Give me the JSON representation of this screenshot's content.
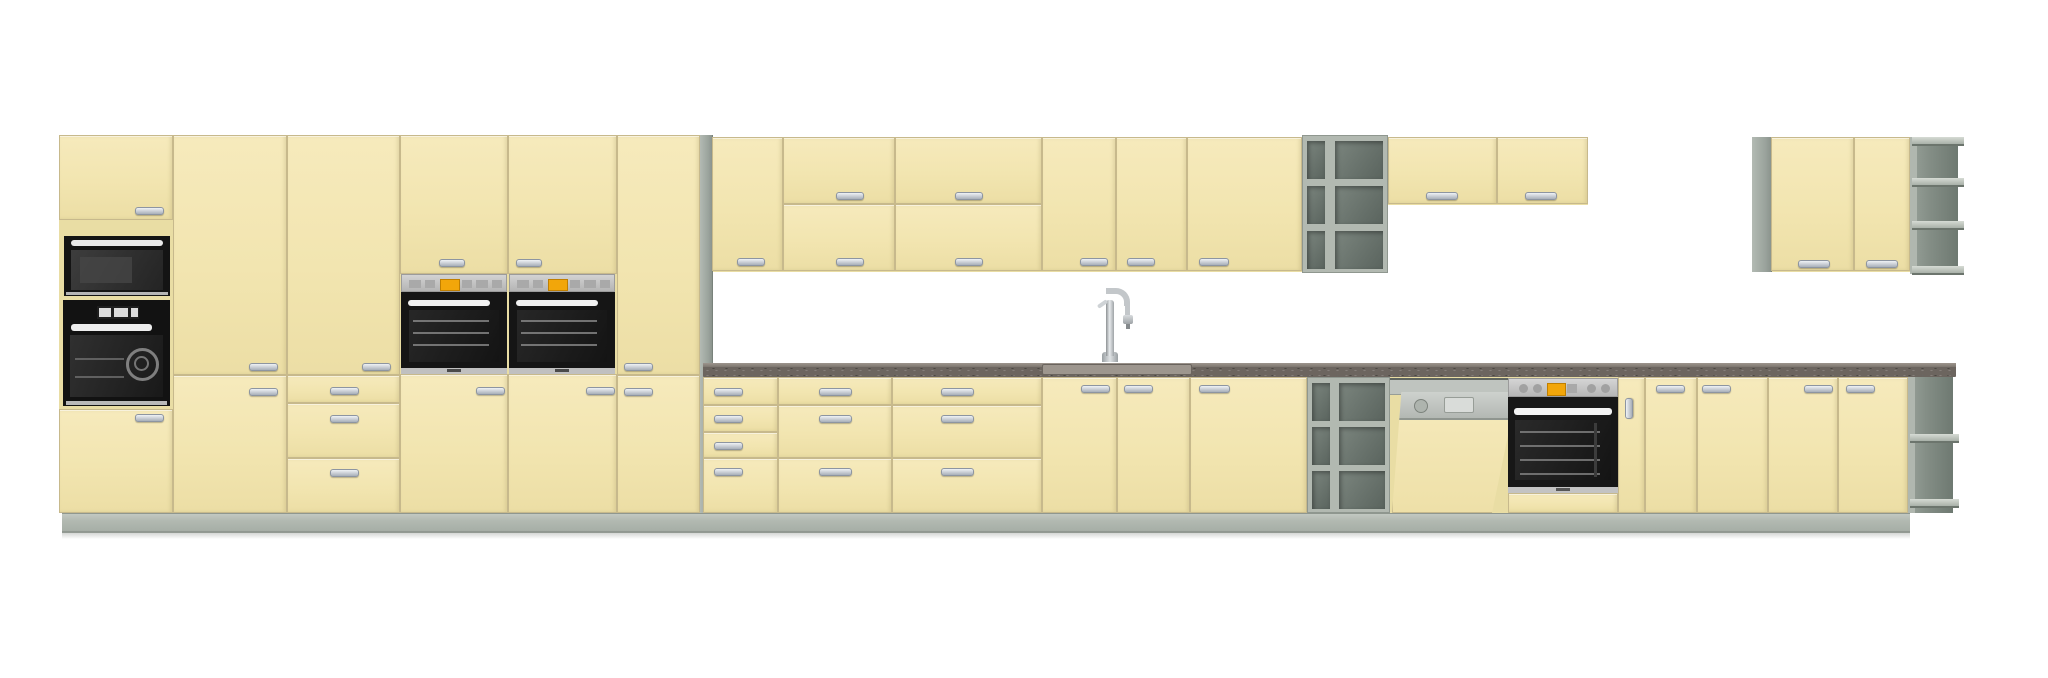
{
  "app": {
    "background": "#ffffff"
  },
  "scene": {
    "description": "3D elevation render of a cream (vanilla) kitchen cabinet run with grey plinth, open shelf units, speckled dark worktop and built-in black/steel appliances",
    "colors": {
      "cream_front": "#f2e5b0",
      "cream_carcass": "#e9dda4",
      "front_border": "#c7b98c",
      "plinth_gray": "#b2b9b1",
      "panel_gray": "#9aa39c",
      "shelf_interior": "#5a645e",
      "counter_dark": "#6c655f",
      "counter_edge": "#978f87",
      "appliance_black": "#151515",
      "appliance_silver": "#c4c4c4",
      "display_orange": "#f2a60a",
      "handle_silver": "#c6ccd4",
      "sink_gray": "#9d968e",
      "faucet_chrome": "#c3c7ca"
    },
    "appliances": [
      "microwave",
      "tall-oven",
      "built-in-oven-mid-1",
      "built-in-oven-mid-2",
      "dishwasher",
      "built-in-oven-base",
      "sink",
      "faucet"
    ],
    "elements": [
      {
        "n": "tall-run-carcass",
        "k": "backing",
        "x": 59,
        "y": 135,
        "w": 641,
        "h": 378
      },
      {
        "n": "base-run-carcass",
        "k": "backing",
        "x": 703,
        "y": 377,
        "w": 1250,
        "h": 136
      },
      {
        "n": "wall-run-carcass",
        "k": "backing",
        "x": 712,
        "y": 137,
        "w": 590,
        "h": 135
      },
      {
        "n": "wall-run-right-carcass",
        "k": "backing",
        "x": 1388,
        "y": 137,
        "w": 200,
        "h": 68
      },
      {
        "n": "far-wall-unit-carcass",
        "k": "backing",
        "x": 1752,
        "y": 137,
        "w": 158,
        "h": 135
      },
      {
        "n": "tall-end-side-panel",
        "k": "panel",
        "x": 700,
        "y": 135,
        "w": 12,
        "h": 378
      },
      {
        "n": "far-wall-side-panel",
        "k": "panel",
        "x": 1752,
        "y": 137,
        "w": 19,
        "h": 135
      },
      {
        "n": "tall1-top-door",
        "k": "door",
        "x": 59,
        "y": 135,
        "w": 114,
        "h": 85,
        "hd": [
          135,
          207,
          27,
          6
        ]
      },
      {
        "n": "tall1-bottom-door",
        "k": "door",
        "x": 59,
        "y": 409,
        "w": 114,
        "h": 104,
        "hd": [
          135,
          414,
          27,
          6
        ]
      },
      {
        "n": "tall2-door",
        "k": "door",
        "x": 173,
        "y": 135,
        "w": 114,
        "h": 240,
        "hd": [
          249,
          363,
          27,
          6
        ]
      },
      {
        "n": "tall2-lower-door",
        "k": "door",
        "x": 173,
        "y": 375,
        "w": 114,
        "h": 138,
        "hd": [
          249,
          388,
          27,
          6
        ]
      },
      {
        "n": "tall3-door",
        "k": "door",
        "x": 287,
        "y": 135,
        "w": 113,
        "h": 240,
        "hd": [
          362,
          363,
          27,
          6
        ]
      },
      {
        "n": "tall3-drawer-1",
        "k": "drawer",
        "x": 287,
        "y": 375,
        "w": 113,
        "h": 28,
        "hd": [
          330,
          387,
          27,
          6
        ]
      },
      {
        "n": "tall3-drawer-2",
        "k": "drawer",
        "x": 287,
        "y": 403,
        "w": 113,
        "h": 55,
        "hd": [
          330,
          415,
          27,
          6
        ]
      },
      {
        "n": "tall3-drawer-3",
        "k": "drawer",
        "x": 287,
        "y": 458,
        "w": 113,
        "h": 55,
        "hd": [
          330,
          469,
          27,
          6
        ]
      },
      {
        "n": "oven1-top-door",
        "k": "door",
        "x": 400,
        "y": 135,
        "w": 108,
        "h": 139,
        "hd": [
          439,
          259,
          24,
          6
        ]
      },
      {
        "n": "oven1-lower-door",
        "k": "door",
        "x": 400,
        "y": 374,
        "w": 108,
        "h": 139,
        "hd": [
          476,
          387,
          27,
          6
        ]
      },
      {
        "n": "oven2-top-door",
        "k": "door",
        "x": 508,
        "y": 135,
        "w": 109,
        "h": 139,
        "hd": [
          516,
          259,
          24,
          6
        ]
      },
      {
        "n": "oven2-lower-door",
        "k": "door",
        "x": 508,
        "y": 374,
        "w": 109,
        "h": 139,
        "hd": [
          586,
          387,
          27,
          6
        ]
      },
      {
        "n": "tall6-door",
        "k": "door",
        "x": 617,
        "y": 135,
        "w": 83,
        "h": 240,
        "hd": [
          624,
          363,
          27,
          6
        ]
      },
      {
        "n": "tall6-lower-door",
        "k": "door",
        "x": 617,
        "y": 375,
        "w": 83,
        "h": 138,
        "hd": [
          624,
          388,
          27,
          6
        ]
      },
      {
        "n": "wall1-door",
        "k": "door",
        "x": 712,
        "y": 137,
        "w": 71,
        "h": 134,
        "hd": [
          737,
          258,
          26,
          6
        ]
      },
      {
        "n": "wall2-top-door",
        "k": "door",
        "x": 783,
        "y": 137,
        "w": 112,
        "h": 67,
        "hd": [
          836,
          192,
          26,
          6
        ]
      },
      {
        "n": "wall2-bottom-door",
        "k": "door",
        "x": 783,
        "y": 204,
        "w": 112,
        "h": 67,
        "hd": [
          836,
          258,
          26,
          6
        ]
      },
      {
        "n": "wall3-top-door",
        "k": "door",
        "x": 895,
        "y": 137,
        "w": 147,
        "h": 67,
        "hd": [
          955,
          192,
          26,
          6
        ]
      },
      {
        "n": "wall3-bottom-door",
        "k": "door",
        "x": 895,
        "y": 204,
        "w": 147,
        "h": 67,
        "hd": [
          955,
          258,
          26,
          6
        ]
      },
      {
        "n": "wall4-door",
        "k": "door",
        "x": 1042,
        "y": 137,
        "w": 74,
        "h": 134,
        "hd": [
          1080,
          258,
          26,
          6
        ]
      },
      {
        "n": "wall5-door",
        "k": "door",
        "x": 1116,
        "y": 137,
        "w": 71,
        "h": 134,
        "hd": [
          1127,
          258,
          26,
          6
        ]
      },
      {
        "n": "wall6-door",
        "k": "door",
        "x": 1187,
        "y": 137,
        "w": 115,
        "h": 134,
        "hd": [
          1199,
          258,
          28,
          6
        ]
      },
      {
        "n": "wall-open-shelf-unit",
        "k": "grid",
        "x": 1302,
        "y": 135,
        "w": 86,
        "h": 138
      },
      {
        "n": "wall7-door",
        "k": "door",
        "x": 1388,
        "y": 137,
        "w": 109,
        "h": 67,
        "hd": [
          1426,
          192,
          30,
          6
        ]
      },
      {
        "n": "wall8-door",
        "k": "door",
        "x": 1497,
        "y": 137,
        "w": 91,
        "h": 67,
        "hd": [
          1525,
          192,
          30,
          6
        ]
      },
      {
        "n": "far-wall-door-1",
        "k": "door",
        "x": 1771,
        "y": 137,
        "w": 83,
        "h": 134,
        "hd": [
          1798,
          260,
          30,
          6
        ]
      },
      {
        "n": "far-wall-door-2",
        "k": "door",
        "x": 1854,
        "y": 137,
        "w": 56,
        "h": 134,
        "hd": [
          1866,
          260,
          30,
          6
        ]
      },
      {
        "n": "far-wall-corner-shelf",
        "k": "corner",
        "x": 1910,
        "y": 137,
        "w": 48,
        "h": 137,
        "bars": [
          0,
          0.3,
          0.61,
          0.94
        ]
      },
      {
        "n": "base1-drawer-1",
        "k": "drawer",
        "x": 703,
        "y": 377,
        "w": 75,
        "h": 28,
        "hd": [
          714,
          388,
          27,
          6
        ]
      },
      {
        "n": "base1-drawer-2",
        "k": "drawer",
        "x": 703,
        "y": 405,
        "w": 75,
        "h": 27,
        "hd": [
          714,
          415,
          27,
          6
        ]
      },
      {
        "n": "base1-drawer-3",
        "k": "drawer",
        "x": 703,
        "y": 432,
        "w": 75,
        "h": 26,
        "hd": [
          714,
          442,
          27,
          6
        ]
      },
      {
        "n": "base1-drawer-4",
        "k": "drawer",
        "x": 703,
        "y": 458,
        "w": 75,
        "h": 55,
        "hd": [
          714,
          468,
          27,
          6
        ]
      },
      {
        "n": "base2-drawer-1",
        "k": "drawer",
        "x": 778,
        "y": 377,
        "w": 114,
        "h": 28,
        "hd": [
          819,
          388,
          31,
          6
        ]
      },
      {
        "n": "base2-drawer-2",
        "k": "drawer",
        "x": 778,
        "y": 405,
        "w": 114,
        "h": 53,
        "hd": [
          819,
          415,
          31,
          6
        ]
      },
      {
        "n": "base2-drawer-3",
        "k": "drawer",
        "x": 778,
        "y": 458,
        "w": 114,
        "h": 55,
        "hd": [
          819,
          468,
          31,
          6
        ]
      },
      {
        "n": "base3-drawer-1",
        "k": "drawer",
        "x": 892,
        "y": 377,
        "w": 150,
        "h": 28,
        "hd": [
          941,
          388,
          31,
          6
        ]
      },
      {
        "n": "base3-drawer-2",
        "k": "drawer",
        "x": 892,
        "y": 405,
        "w": 150,
        "h": 53,
        "hd": [
          941,
          415,
          31,
          6
        ]
      },
      {
        "n": "base3-drawer-3",
        "k": "drawer",
        "x": 892,
        "y": 458,
        "w": 150,
        "h": 55,
        "hd": [
          941,
          468,
          31,
          6
        ]
      },
      {
        "n": "sink-base-door-left",
        "k": "door",
        "x": 1042,
        "y": 377,
        "w": 75,
        "h": 136,
        "hd": [
          1081,
          385,
          27,
          6
        ]
      },
      {
        "n": "sink-base-door-right",
        "k": "door",
        "x": 1117,
        "y": 377,
        "w": 73,
        "h": 136,
        "hd": [
          1124,
          385,
          27,
          6
        ]
      },
      {
        "n": "base4-door",
        "k": "door",
        "x": 1190,
        "y": 377,
        "w": 117,
        "h": 136,
        "hd": [
          1199,
          385,
          29,
          6
        ]
      },
      {
        "n": "base-open-shelf-unit",
        "k": "grid",
        "x": 1307,
        "y": 377,
        "w": 83,
        "h": 136
      },
      {
        "n": "dishwasher",
        "k": "dw",
        "x": 1390,
        "y": 377,
        "w": 130,
        "h": 136
      },
      {
        "n": "built-in-oven-base",
        "k": "ovenb",
        "x": 1508,
        "y": 377,
        "w": 110,
        "h": 136
      },
      {
        "n": "base-filler-door",
        "k": "door",
        "x": 1618,
        "y": 377,
        "w": 27,
        "h": 136,
        "hv": [
          1625,
          398,
          6,
          19
        ]
      },
      {
        "n": "base5-door",
        "k": "door",
        "x": 1645,
        "y": 377,
        "w": 52,
        "h": 136,
        "hd": [
          1656,
          385,
          27,
          6
        ]
      },
      {
        "n": "base6-door",
        "k": "door",
        "x": 1697,
        "y": 377,
        "w": 71,
        "h": 136,
        "hd": [
          1702,
          385,
          27,
          6
        ]
      },
      {
        "n": "base7-door",
        "k": "door",
        "x": 1768,
        "y": 377,
        "w": 70,
        "h": 136,
        "hd": [
          1804,
          385,
          27,
          6
        ]
      },
      {
        "n": "base8-door",
        "k": "door",
        "x": 1838,
        "y": 377,
        "w": 70,
        "h": 136,
        "hd": [
          1846,
          385,
          27,
          6
        ]
      },
      {
        "n": "base-corner-shelf",
        "k": "corner",
        "x": 1908,
        "y": 377,
        "w": 45,
        "h": 136,
        "bars": [
          0.42,
          0.9
        ]
      },
      {
        "n": "microwave",
        "k": "micro",
        "x": 64,
        "y": 236,
        "w": 106,
        "h": 60
      },
      {
        "n": "tall-oven",
        "k": "ovent",
        "x": 63,
        "y": 300,
        "w": 107,
        "h": 106
      },
      {
        "n": "built-in-oven-mid-1",
        "k": "ovenm",
        "x": 401,
        "y": 274,
        "w": 106,
        "h": 100
      },
      {
        "n": "built-in-oven-mid-2",
        "k": "ovenm",
        "x": 509,
        "y": 274,
        "w": 106,
        "h": 100
      },
      {
        "n": "countertop",
        "k": "counter",
        "x": 703,
        "y": 363,
        "w": 1253,
        "h": 14,
        "sink": [
          1042,
          148
        ]
      },
      {
        "n": "faucet",
        "k": "faucet",
        "x": 1096,
        "y": 286,
        "w": 40,
        "h": 78
      },
      {
        "n": "plinth",
        "k": "plinth",
        "x": 62,
        "y": 513,
        "w": 1848,
        "h": 19
      },
      {
        "n": "floor-shadow",
        "k": "shadow",
        "x": 62,
        "y": 531,
        "w": 1848,
        "h": 8
      }
    ]
  }
}
